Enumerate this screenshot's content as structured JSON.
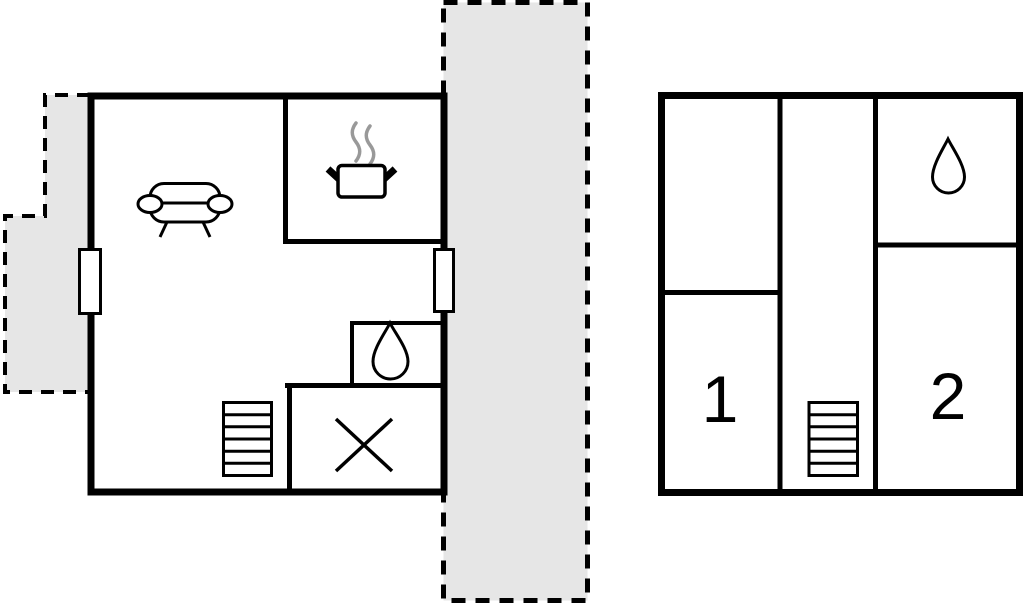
{
  "canvas": {
    "width_px": 1024,
    "height_px": 603
  },
  "colors": {
    "walls": "#000000",
    "terrace_fill": "#e6e6e6",
    "water_drop_fill": "#b2f0f2",
    "steam_gray": "#999999",
    "background": "#ffffff"
  },
  "left_plan": {
    "name": "floor-plan-left",
    "icons": [
      "sofa-icon",
      "cooking-pot-icon",
      "steam-icon",
      "water-drop-icon",
      "stairs-icon",
      "cross-icon"
    ],
    "door_count": 2
  },
  "right_plan": {
    "name": "floor-plan-right",
    "room_labels": {
      "room1": "1",
      "room2": "2"
    },
    "icons": [
      "water-drop-icon",
      "stairs-icon"
    ]
  }
}
